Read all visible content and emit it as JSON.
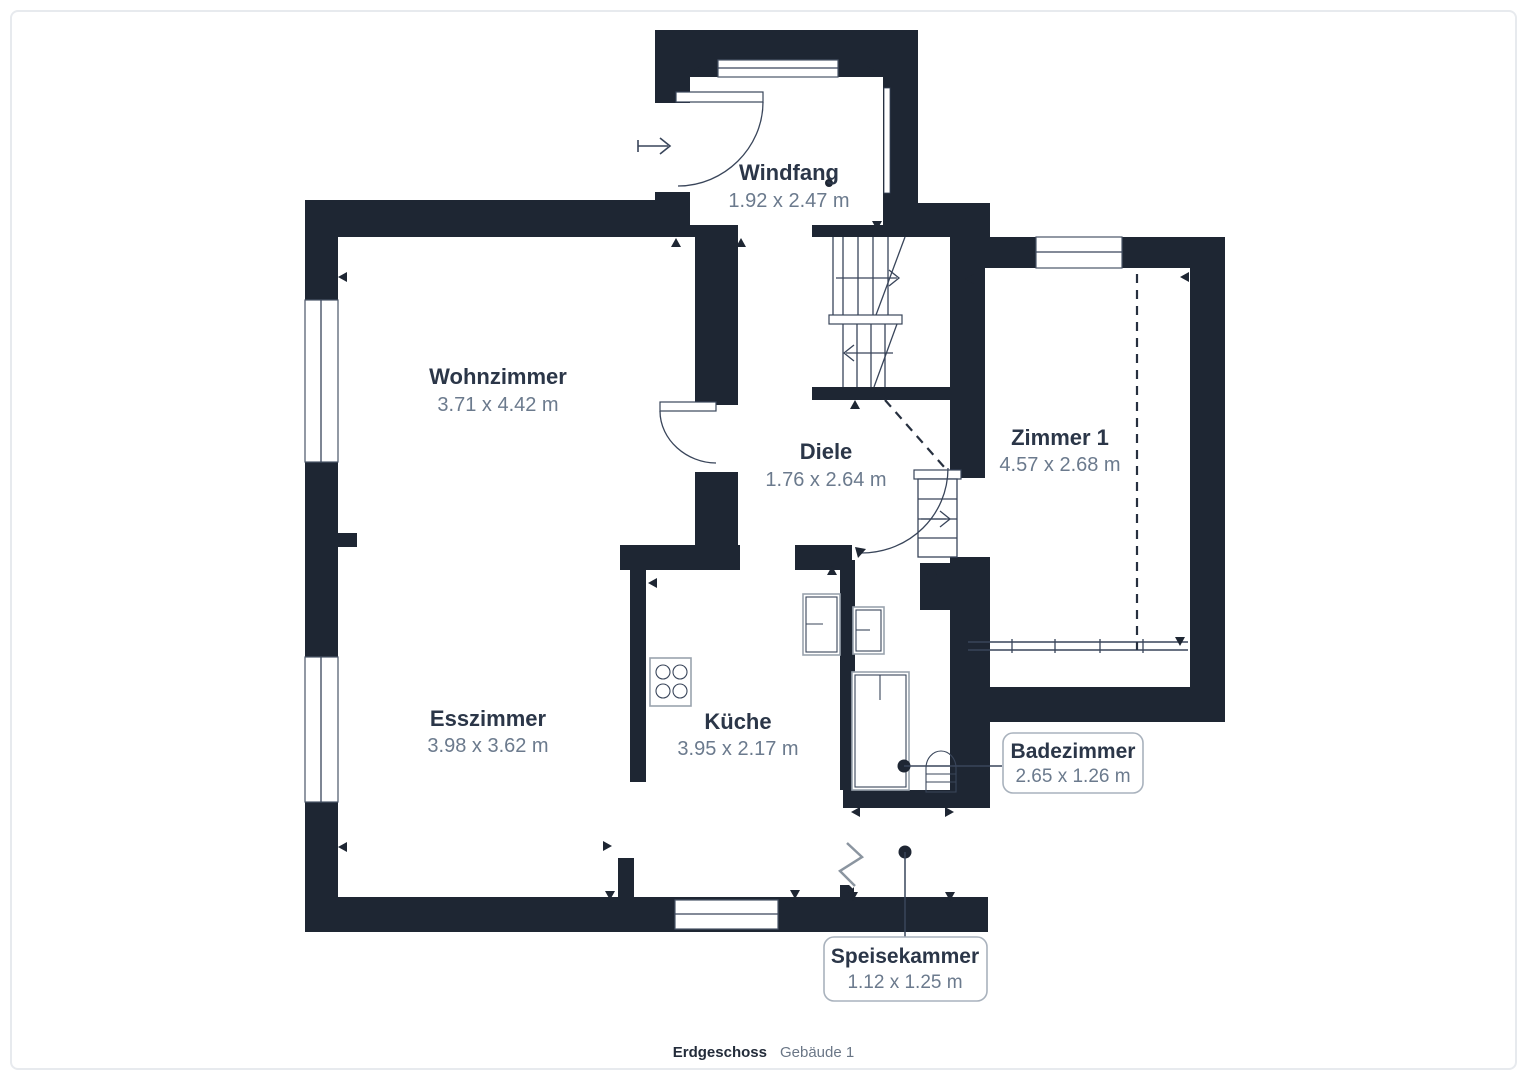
{
  "title": "Grundriss Erdgeschoss",
  "colors": {
    "wall": "#1e2633",
    "room_name": "#2b3648",
    "room_dim": "#6b7a8d",
    "fixture_line": "#9aa3ae",
    "callout_border": "#a9b2bd",
    "page_frame": "#e7eaee",
    "background": "#ffffff"
  },
  "rooms": {
    "windfang": {
      "name": "Windfang",
      "dims": "1.92 x 2.47 m"
    },
    "wohnzimmer": {
      "name": "Wohnzimmer",
      "dims": "3.71 x 4.42 m"
    },
    "diele": {
      "name": "Diele",
      "dims": "1.76 x 2.64 m"
    },
    "zimmer1": {
      "name": "Zimmer 1",
      "dims": "4.57 x 2.68 m"
    },
    "esszimmer": {
      "name": "Esszimmer",
      "dims": "3.98 x 3.62 m"
    },
    "kueche": {
      "name": "Küche",
      "dims": "3.95 x 2.17 m"
    }
  },
  "callouts": {
    "badezimmer": {
      "name": "Badezimmer",
      "dims": "2.65 x 1.26 m"
    },
    "speisekammer": {
      "name": "Speisekammer",
      "dims": "1.12 x 1.25 m"
    }
  },
  "footer": {
    "floor": "Erdgeschoss",
    "building": "Gebäude 1"
  }
}
